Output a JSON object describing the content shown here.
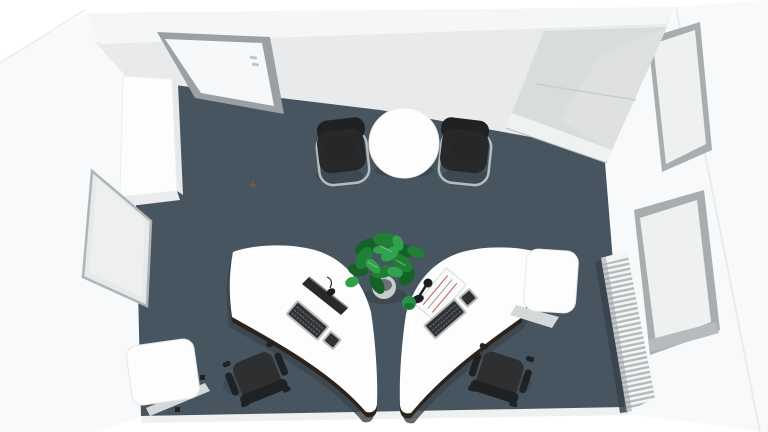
{
  "scene": {
    "description": "Top-down 3D render of an office room with dark slate floor and white walls",
    "view": "bird's-eye perspective",
    "room_type": "office"
  },
  "colors": {
    "background": "#ffffff",
    "floor": "#475560",
    "floor_shadow": "#39434c",
    "wall_face": "#e8eaeb",
    "wall_top": "#f5f6f6",
    "wall_white": "#f8f9fa",
    "outer_edge": "#e9ebec",
    "bottom_strip": "#eff1f1",
    "door_frame": "#9aa0a3",
    "door_panel": "#f7f8f9",
    "door_handle": "#c2c6c8",
    "sideboard_top": "#d9dcdd",
    "sideboard_front": "#f0f2f2",
    "window_frame": "#a8aeb0",
    "window_pane": "#eff1f1",
    "window_sill": "#b6bbbd",
    "radiator_fin": "#f4f5f5",
    "radiator_gap": "#b4babc",
    "radiator_shade": "#9aa0a3",
    "desk": "#fdfdfe",
    "desk_rim": "#2b231c",
    "table": "#fefefe",
    "visitor_chair": "#26282a",
    "chair_frame": "#b6bbbd",
    "task_chair": "#2d2f31",
    "task_chair_dark": "#1f2123",
    "plant_dark": "#156128",
    "plant_mid": "#1f8035",
    "plant_light": "#2fa24c",
    "pot": "#c8cccd",
    "cabinet": "#fcfdfd",
    "cabinet_side": "#e6e8e9",
    "whiteboard": "#e7e9ea",
    "whiteboard_frame": "#afb4b6",
    "box": "#fdfdfd",
    "box_side": "#d5d8d9",
    "keyboard_frame": "#b9bcbe",
    "keyboard_keys": "#2f3133",
    "monitor": "#27292b",
    "paper": "#fbfbfb",
    "paper_line": "#b85c4e",
    "lamp": "#1b1d1f",
    "desk_ball": "#2a9247",
    "floor_marker": "#7d5f41"
  },
  "objects": [
    {
      "name": "door",
      "label": "entrance door"
    },
    {
      "name": "wardrobe-left",
      "label": "tall white wardrobe"
    },
    {
      "name": "whiteboard",
      "label": "leaning board"
    },
    {
      "name": "meeting-table",
      "label": "round white table"
    },
    {
      "name": "visitor-chair-left",
      "label": "black cantilever chair"
    },
    {
      "name": "visitor-chair-right",
      "label": "black cantilever chair"
    },
    {
      "name": "plant",
      "label": "green potted plant"
    },
    {
      "name": "desk-left",
      "label": "curved white desk with monitor and keyboard"
    },
    {
      "name": "desk-right",
      "label": "curved white desk with papers, lamp and keyboard"
    },
    {
      "name": "task-chair-left",
      "label": "black office chair"
    },
    {
      "name": "task-chair-right",
      "label": "black office chair"
    },
    {
      "name": "storage-box",
      "label": "white storage box"
    },
    {
      "name": "storage-cube",
      "label": "white cube cabinet"
    },
    {
      "name": "sideboard",
      "label": "white sideboard in corner"
    },
    {
      "name": "window-upper",
      "label": "window"
    },
    {
      "name": "window-lower",
      "label": "window"
    },
    {
      "name": "radiator",
      "label": "white finned radiator"
    }
  ]
}
